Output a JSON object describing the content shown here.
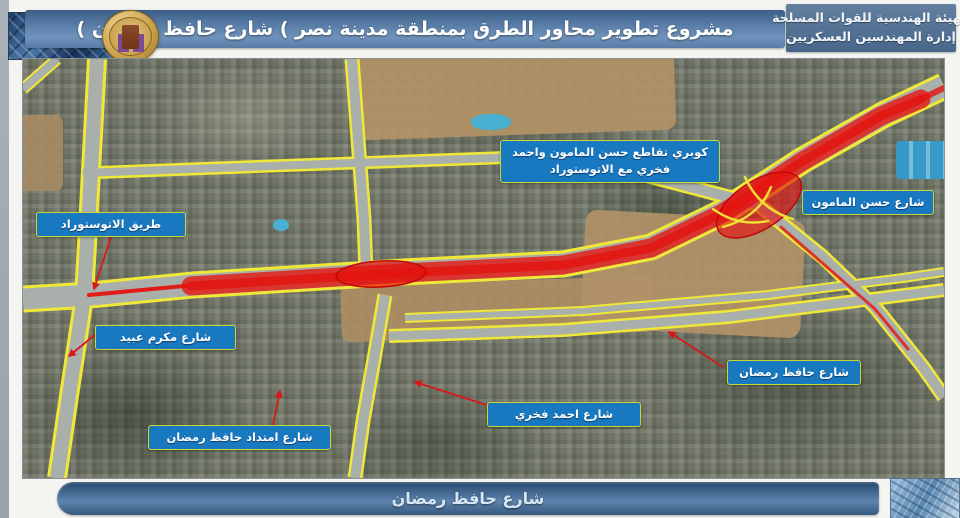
{
  "header": {
    "org_line1": "الهيئة الهندسية للقوات المسلحة",
    "org_line2": "إدارة المهندسين العسكريين",
    "title": "مشروع تطوير محاور الطرق بمنطقة مدينة نصر ) شارع حافظ رمضان )"
  },
  "map": {
    "labels": [
      {
        "id": "autostrad-road",
        "text": "طريق الاتوستوراد"
      },
      {
        "id": "mamoun-fakhry-autostrad-bridge",
        "text": "كوبري تقاطع حسن المامون واحمد فخري مع الاتوستوراد"
      },
      {
        "id": "hassan-mamoun-street",
        "text": "شارع حسن المامون"
      },
      {
        "id": "makram-ebeid-street",
        "text": "شارع مكرم عبيد"
      },
      {
        "id": "hafez-ramadan-extension-street",
        "text": "شارع امتداد حافظ رمضان"
      },
      {
        "id": "ahmed-fakhry-street",
        "text": "شارع احمد فخري"
      },
      {
        "id": "hafez-ramadan-street",
        "text": "شارع حافظ رمضان"
      }
    ],
    "colors": {
      "project_highlight": "#e41410",
      "road_edge": "#efe838",
      "label_background": "#1878c0",
      "label_border": "#c6d838"
    }
  },
  "footer": {
    "title": "شارع حافظ رمضان"
  }
}
